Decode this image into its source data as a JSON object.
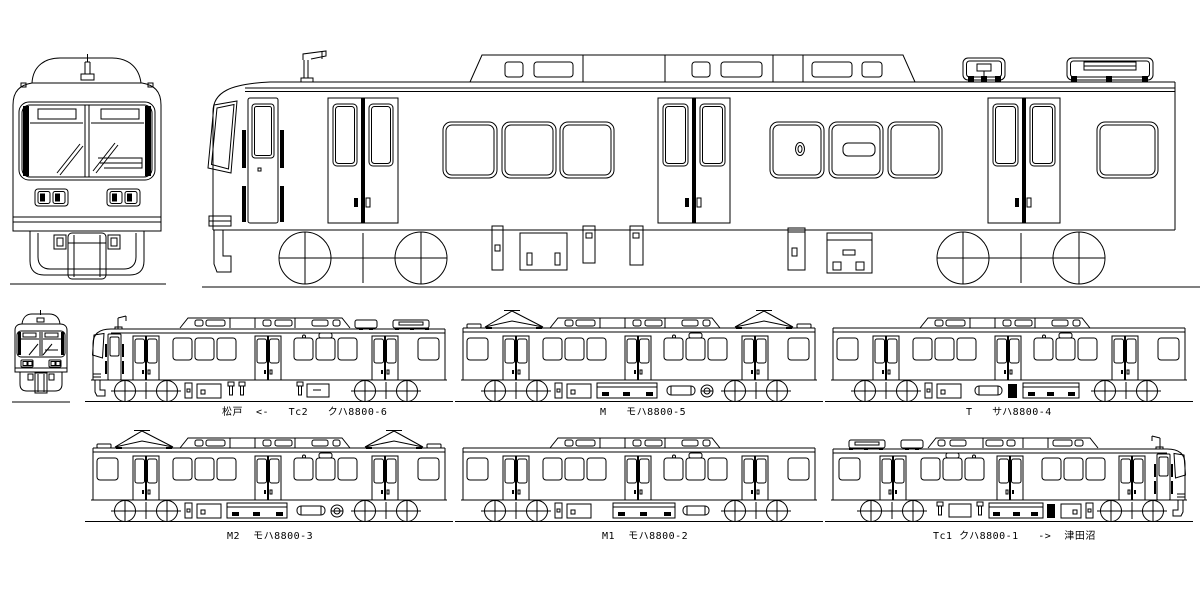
{
  "colors": {
    "line": "#000000",
    "background": "#ffffff"
  },
  "formation": {
    "cars": [
      {
        "key": "tc2",
        "row": 1,
        "col": 1,
        "label": "松戸  <-   Tc2   クハ8800-6",
        "cab": "left",
        "pantographs": 0,
        "roof_antenna": true,
        "roof_boxes": true,
        "equipment": "tc"
      },
      {
        "key": "m",
        "row": 1,
        "col": 2,
        "label": "M   モハ8800-5",
        "cab": "none",
        "pantographs": 2,
        "roof_antenna": false,
        "roof_boxes": false,
        "equipment": "m"
      },
      {
        "key": "t",
        "row": 1,
        "col": 3,
        "label": "T   サハ8800-4",
        "cab": "none",
        "pantographs": 0,
        "roof_antenna": false,
        "roof_boxes": false,
        "equipment": "t"
      },
      {
        "key": "m2",
        "row": 2,
        "col": 1,
        "label": "M2  モハ8800-3",
        "cab": "none",
        "pantographs": 2,
        "roof_antenna": false,
        "roof_boxes": false,
        "equipment": "m"
      },
      {
        "key": "m1",
        "row": 2,
        "col": 2,
        "label": "M1  モハ8800-2",
        "cab": "none",
        "pantographs": 0,
        "roof_antenna": false,
        "roof_boxes": false,
        "equipment": "m1"
      },
      {
        "key": "tc1",
        "row": 2,
        "col": 3,
        "label": "Tc1 クハ8800-1   ->  津田沼",
        "cab": "right",
        "pantographs": 0,
        "roof_antenna": true,
        "roof_boxes": true,
        "equipment": "tc1"
      }
    ]
  }
}
